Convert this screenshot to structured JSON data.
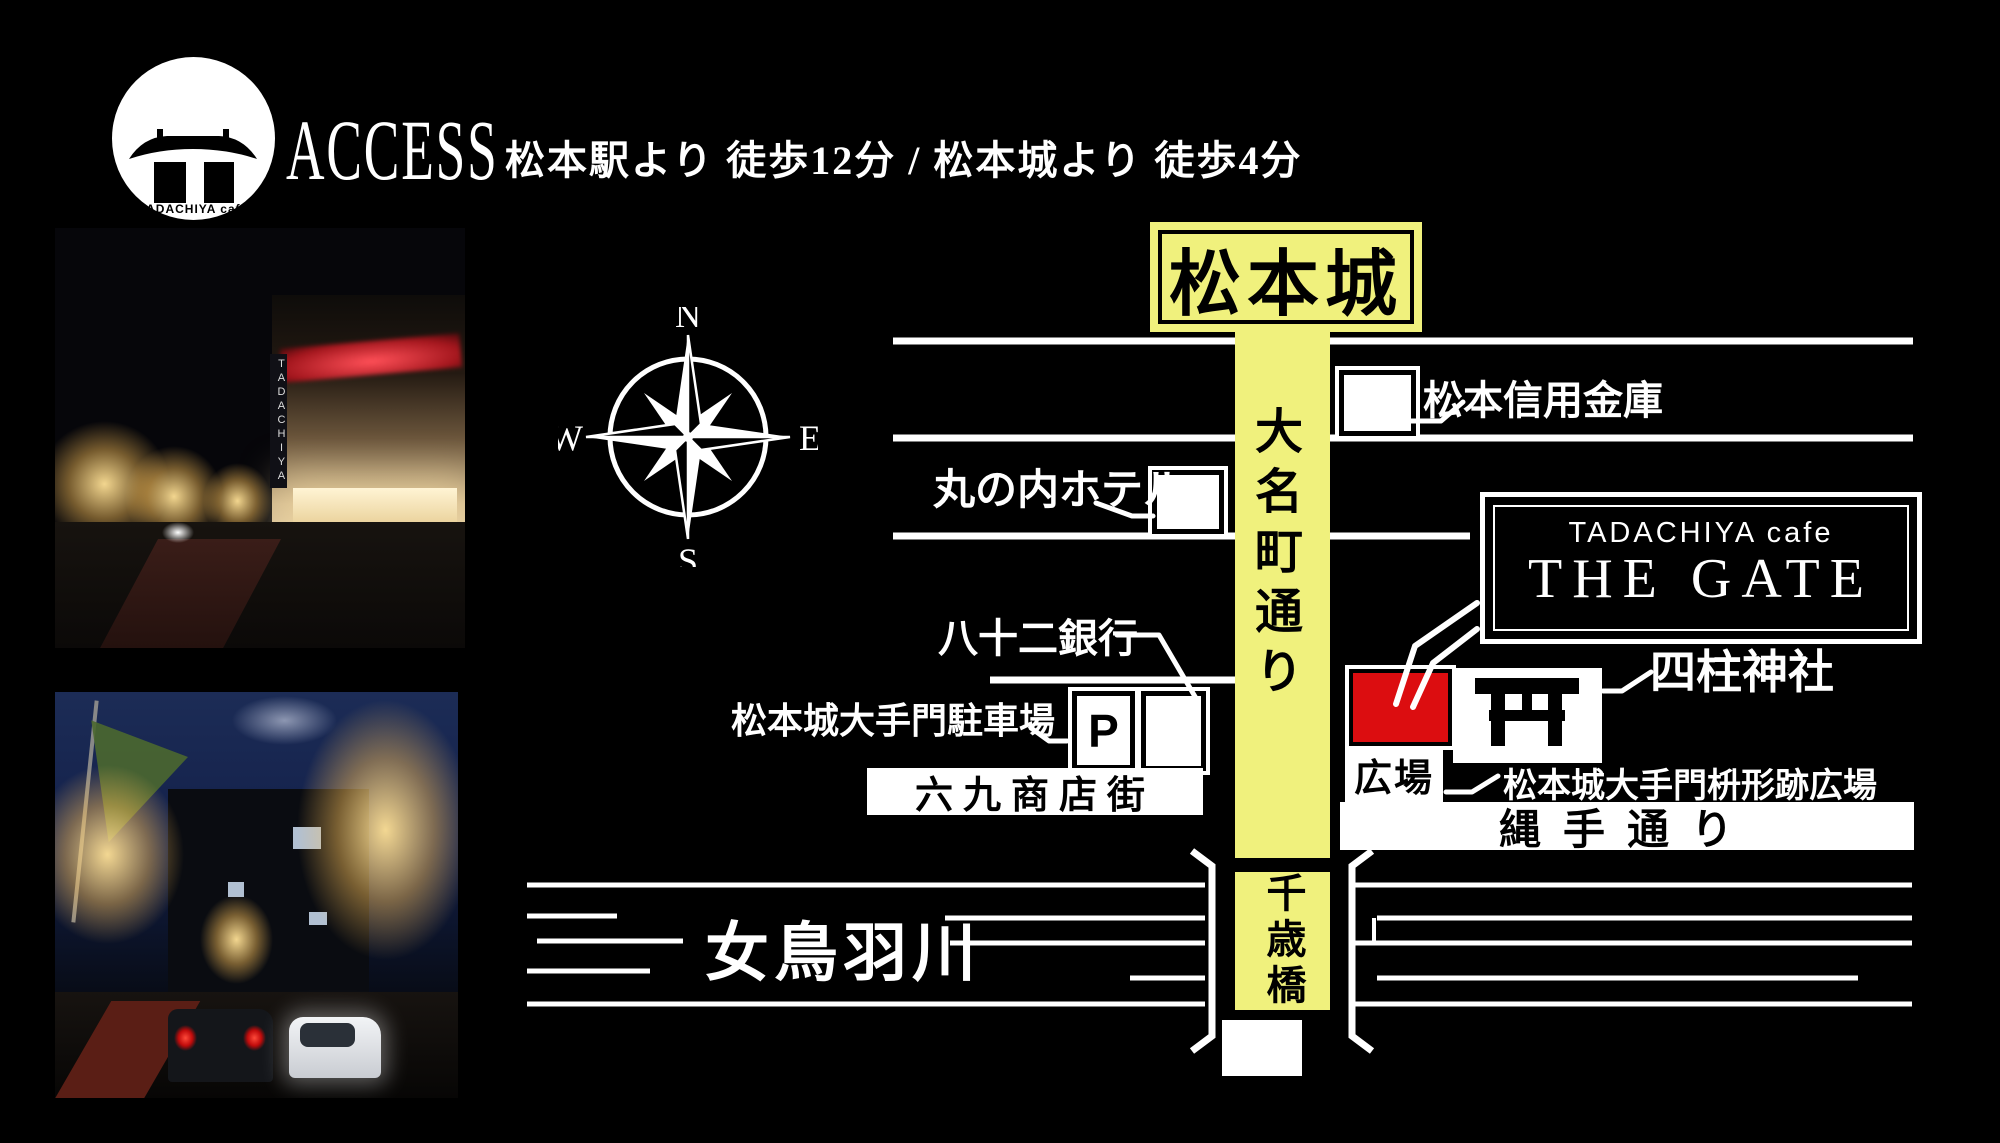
{
  "logo": {
    "brand_top": "TADACHIYA cafe",
    "brand_main": "THE GATE"
  },
  "header": {
    "title": "ACCESS",
    "subtitle": "松本駅より 徒歩12分 / 松本城より 徒歩4分"
  },
  "compass": {
    "n": "N",
    "e": "E",
    "s": "S",
    "w": "W"
  },
  "map": {
    "castle": "松本城",
    "daimyocho_street": "大名町通り",
    "shinkin_bank": "松本信用金庫",
    "marunouchi_hotel": "丸の内ホテル",
    "hachijuni_bank": "八十二銀行",
    "otemon_parking": "松本城大手門駐車場",
    "parking_mark": "P",
    "rokku_street": "六九商店街",
    "cafe_sign": {
      "top": "TADACHIYA cafe",
      "main": "THE GATE"
    },
    "plaza": "広場",
    "yohashira_shrine": "四柱神社",
    "masugata_plaza": "松本城大手門枡形跡広場",
    "nawate_street": "縄手通り",
    "metoba_river": "女鳥羽川",
    "chitose_bridge": "千歳橋"
  },
  "photos": {
    "top_sign_text": "TADACHIYA"
  },
  "colors": {
    "background": "#000000",
    "road_yellow": "#f0f17d",
    "cafe_red": "#dc0d10",
    "line_white": "#ffffff"
  }
}
